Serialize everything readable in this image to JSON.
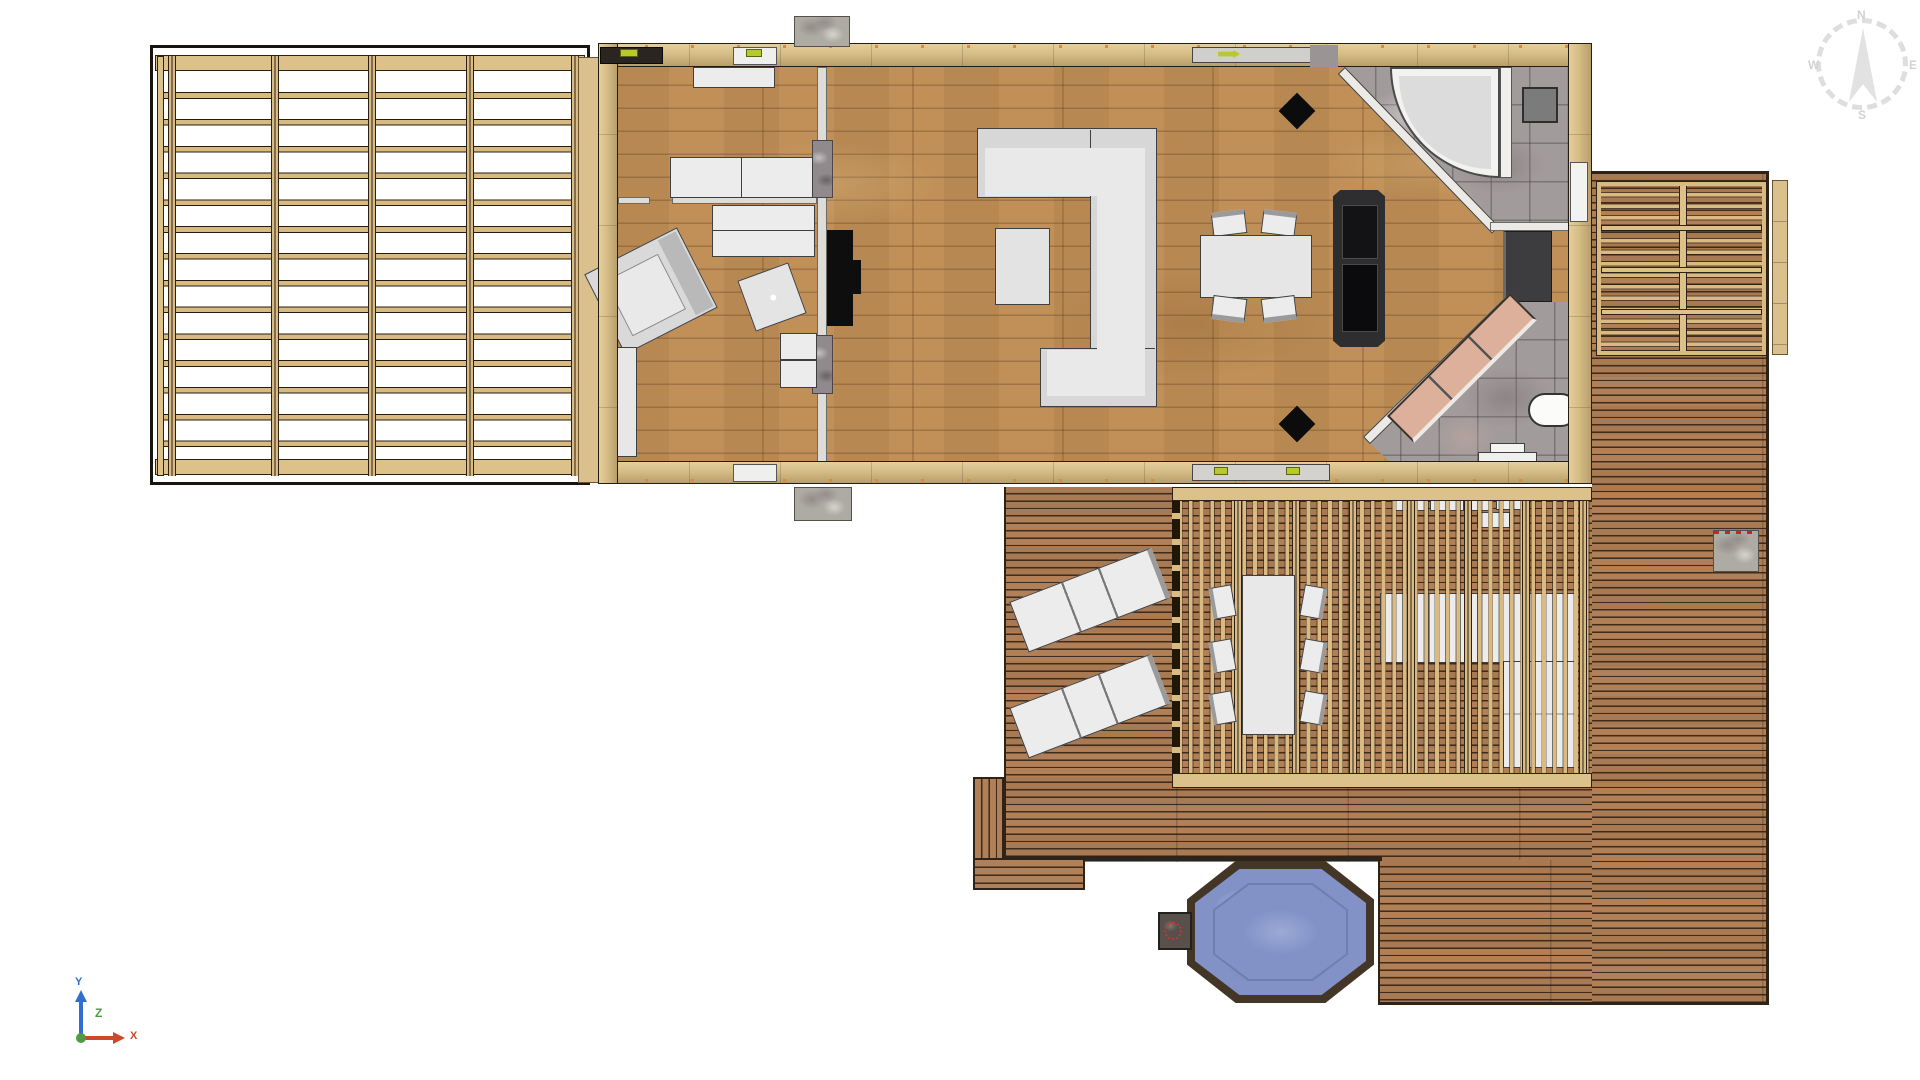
{
  "compass": {
    "n": "N",
    "e": "E",
    "s": "S",
    "w": "W"
  },
  "axes": {
    "x": "X",
    "y": "Y",
    "z": "Z",
    "x_color": "#cc4a2a",
    "y_color": "#2f6fd0",
    "z_color": "#4a9e3f"
  },
  "colors": {
    "interior_floor_oak": "#c09058",
    "deck_wood": "#a8764e",
    "pergola_wood": "#d8ba82",
    "wall_wood": "#d6bd86",
    "tile_gray": "#a29b9c",
    "furniture_white": "#ececec",
    "island_black": "#2e2e30",
    "stove_black": "#111111",
    "sauna_bench_tan": "#dcb09a",
    "hot_tub_water": "#8292c7",
    "hot_tub_rim": "#443627",
    "concrete": "#aeaaa4",
    "door_marker_olive": "#b8c92c"
  },
  "plan": {
    "view": "top-down floor plan render",
    "rooms": [
      "pergola-carport",
      "bedroom-upper",
      "bedroom-lower",
      "living-room",
      "dining-kitchen",
      "bathroom-northeast",
      "sauna-southeast",
      "deck-terrace",
      "covered-dining-pergola",
      "side-deck"
    ],
    "furniture": {
      "indoor": [
        "wall-shelf",
        "double-bed-upper",
        "double-bed-lower",
        "armchair",
        "side-table-rotated",
        "nightstand",
        "wardrobe",
        "c-shaped-sofa",
        "coffee-table",
        "dining-table-4-chairs",
        "black-kitchen-island",
        "wood-stove",
        "ceiling-lamp-diamond-x2"
      ],
      "bathroom": [
        "corner-shower",
        "washing-machine",
        "bathroom-heater"
      ],
      "sauna": [
        "diagonal-sauna-bench",
        "toilet",
        "wash-basin"
      ],
      "outdoor": [
        "sun-lounger-x2",
        "outdoor-dining-table-6-chairs",
        "outdoor-l-sofa",
        "wall-bench-cushions",
        "hot-tub-octagonal",
        "hot-tub-pump-box",
        "concrete-step-x3",
        "deck-stairs"
      ]
    }
  }
}
